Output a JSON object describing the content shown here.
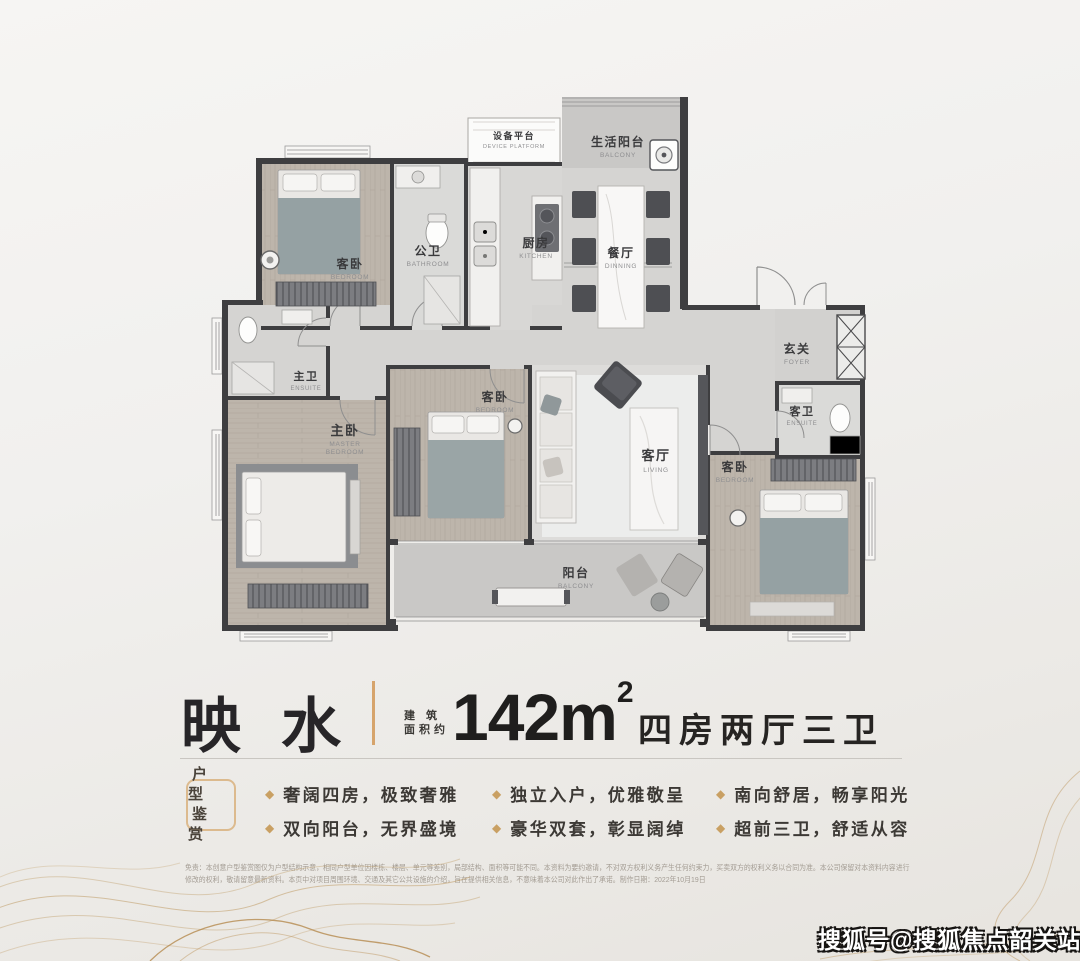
{
  "title": {
    "name": "映水",
    "area_label_line1": "建 筑",
    "area_label_line2": "面积约",
    "area_value": "142m",
    "area_sup": "2",
    "spec": "四房两厅三卫"
  },
  "badge": {
    "line1": "户 型",
    "line2": "鉴 赏"
  },
  "features": {
    "bullet_glyph": "◆",
    "items": [
      "奢阔四房，极致奢雅",
      "双向阳台，无界盛境",
      "独立入户，优雅敬呈",
      "豪华双套，彰显阔绰",
      "南向舒居，畅享阳光",
      "超前三卫，舒适从容"
    ]
  },
  "floorplan": {
    "rooms": [
      {
        "id": "device-platform",
        "cn": "设备平台",
        "en": "DEVICE PLATFORM"
      },
      {
        "id": "life-balcony",
        "cn": "生活阳台",
        "en": "BALCONY"
      },
      {
        "id": "bedroom-nw",
        "cn": "客卧",
        "en": "BEDROOM"
      },
      {
        "id": "public-bathroom",
        "cn": "公卫",
        "en": "BATHROOM"
      },
      {
        "id": "kitchen",
        "cn": "厨房",
        "en": "KITCHEN"
      },
      {
        "id": "dining",
        "cn": "餐厅",
        "en": "DINNING"
      },
      {
        "id": "foyer",
        "cn": "玄关",
        "en": "FOYER"
      },
      {
        "id": "master-ensuite",
        "cn": "主卫",
        "en": "ENSUITE"
      },
      {
        "id": "master-bedroom",
        "cn": "主卧",
        "en": "MASTER",
        "en2": "BEDROOM"
      },
      {
        "id": "bedroom-mid",
        "cn": "客卧",
        "en": "BEDROOM"
      },
      {
        "id": "living",
        "cn": "客厅",
        "en": "LIVING"
      },
      {
        "id": "guest-ensuite",
        "cn": "客卫",
        "en": "ENSUITE"
      },
      {
        "id": "bedroom-se",
        "cn": "客卧",
        "en": "BEDROOM"
      },
      {
        "id": "balcony",
        "cn": "阳台",
        "en": "BALCONY"
      }
    ]
  },
  "disclaimer": {
    "line1": "免责：本创意户型鉴赏图仅为户型结构示意，相同户型单位因楼栋、楼层、单元等差别，局部结构、面积等可能不同。本资料为要约邀请，不对双方权利义务产生任何约束力，买卖双方的权利义务以合同为准。本公司保留对本资料内容进行",
    "line2": "修改的权利，敬请留意最新资料。本页中对项目周围环境、交通及其它公共设施的介绍，旨在提供相关信息，不意味着本公司对此作出了承诺。制作日期：2022年10月19日"
  },
  "watermark": {
    "text": "搜狐号@搜狐焦点韶关站"
  },
  "colors": {
    "accent_gold": "#c9a063",
    "divider_gold": "#d6a46c",
    "wall": "#3e3e40",
    "title_ink": "#1f1e1d",
    "wave_gold": "#bf9a64"
  }
}
